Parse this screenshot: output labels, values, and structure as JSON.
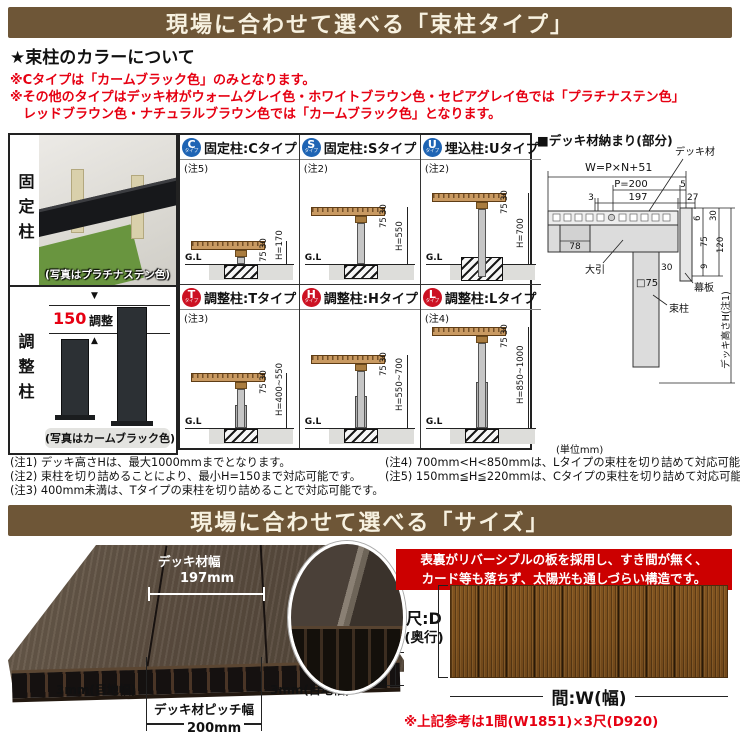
{
  "colors": {
    "banner_bg": "#6e5637",
    "accent_red": "#e60012",
    "feature_box_red": "#cc0000",
    "badge_blue": "#1e64b4",
    "badge_red": "#cc1122"
  },
  "banner1": {
    "text": "現場に合わせて選べる「束柱タイプ」"
  },
  "color_info": {
    "heading": "★束柱のカラーについて",
    "line1": "※Cタイプは「カームブラック色」のみとなります。",
    "line2": "※その他のタイプはデッキ材がウォームグレイ色・ホワイトブラウン色・セピアグレイ色では「プラチナステン色」",
    "line3": "レッドブラウン色・ナチュラルブラウン色では「カームブラック色」となります。"
  },
  "photo_panel": {
    "fixed_label": "固定柱",
    "fixed_caption": "(写真はプラチナステン色)",
    "adjust_label": "調整柱",
    "adjust_caption": "(写真はカームブラック色)",
    "adjust_dim_value": "150",
    "adjust_dim_text": "調整",
    "arrow_down": "▼",
    "arrow_up": "▲"
  },
  "type_table": {
    "cells": [
      {
        "badge": "C",
        "badge_sub": "タイプ",
        "title": "固定柱:Cタイプ",
        "note": "(注5)",
        "d_board": "30",
        "d_joist": "75",
        "d_h": "H=170",
        "gl": "G.L"
      },
      {
        "badge": "S",
        "badge_sub": "タイプ",
        "title": "固定柱:Sタイプ",
        "note": "(注2)",
        "d_board": "30",
        "d_joist": "75",
        "d_h": "H=550",
        "gl": "G.L"
      },
      {
        "badge": "U",
        "badge_sub": "タイプ",
        "title": "埋込柱:Uタイプ",
        "note": "(注2)",
        "d_board": "30",
        "d_joist": "75",
        "d_h": "H=700",
        "gl": "G.L"
      },
      {
        "badge": "T",
        "badge_sub": "タイプ",
        "title": "調整柱:Tタイプ",
        "note": "(注3)",
        "d_board": "30",
        "d_joist": "75",
        "d_h": "H=400~550",
        "gl": "G.L"
      },
      {
        "badge": "H",
        "badge_sub": "タイプ",
        "title": "調整柱:Hタイプ",
        "note": "",
        "d_board": "30",
        "d_joist": "75",
        "d_h": "H=550~700",
        "gl": "G.L"
      },
      {
        "badge": "L",
        "badge_sub": "タイプ",
        "title": "調整柱:Lタイプ",
        "note": "(注4)",
        "d_board": "30",
        "d_joist": "75",
        "d_h": "H=850~1000",
        "gl": "G.L"
      }
    ],
    "unit_note": "(単位mm)"
  },
  "detail_diagram": {
    "title": "■デッキ材納まり(部分)",
    "labels": {
      "deck_material": "デッキ材",
      "w_formula": "W=P×N+51",
      "p200": "P=200",
      "n5": "5",
      "n3": "3",
      "n197": "197",
      "n27": "27",
      "n6": "6",
      "n30_top": "30",
      "n120": "120",
      "n75": "75",
      "n9": "9",
      "n30_bottom": "30",
      "n78": "78",
      "obiki": "大引",
      "sq75": "□75",
      "makuita": "幕板",
      "tsukabashira": "束柱",
      "deck_height": "デッキ高さH(注1)"
    }
  },
  "footnotes": {
    "left": [
      "(注1) デッキ高さHは、最大1000mmまでとなります。",
      "(注2) 束柱を切り詰めることにより、最小H=150まで対応可能です。",
      "(注3) 400mm未満は、Tタイプの束柱を切り詰めることで対応可能です。"
    ],
    "right": [
      "(注4) 700mm<H<850mmは、Lタイプの束柱を切り詰めて対応可能です。",
      "(注5) 150mm≦H≦220mmは、Cタイプの束柱を切り詰めて対応可能です。"
    ]
  },
  "banner2": {
    "text": "現場に合わせて選べる「サイズ」"
  },
  "size_section": {
    "deck_width_label": "デッキ材幅",
    "deck_width_value": "197mm",
    "joint_left": "3mm(目地幅)",
    "joint_right": "3mm(目地幅)",
    "pitch_label": "デッキ材ピッチ幅",
    "pitch_value": "200mm",
    "thickness": "30mm",
    "feature_line1": "表裏がリバーシブルの板を採用し、すき間が無く、",
    "feature_line2": "カード等も落ちず、太陽光も通しづらい構造です。",
    "depth_label": "尺:D",
    "depth_sub": "(奥行)",
    "width_label": "間:W(幅)",
    "reference": "※上記参考は1間(W1851)×3尺(D920)"
  }
}
